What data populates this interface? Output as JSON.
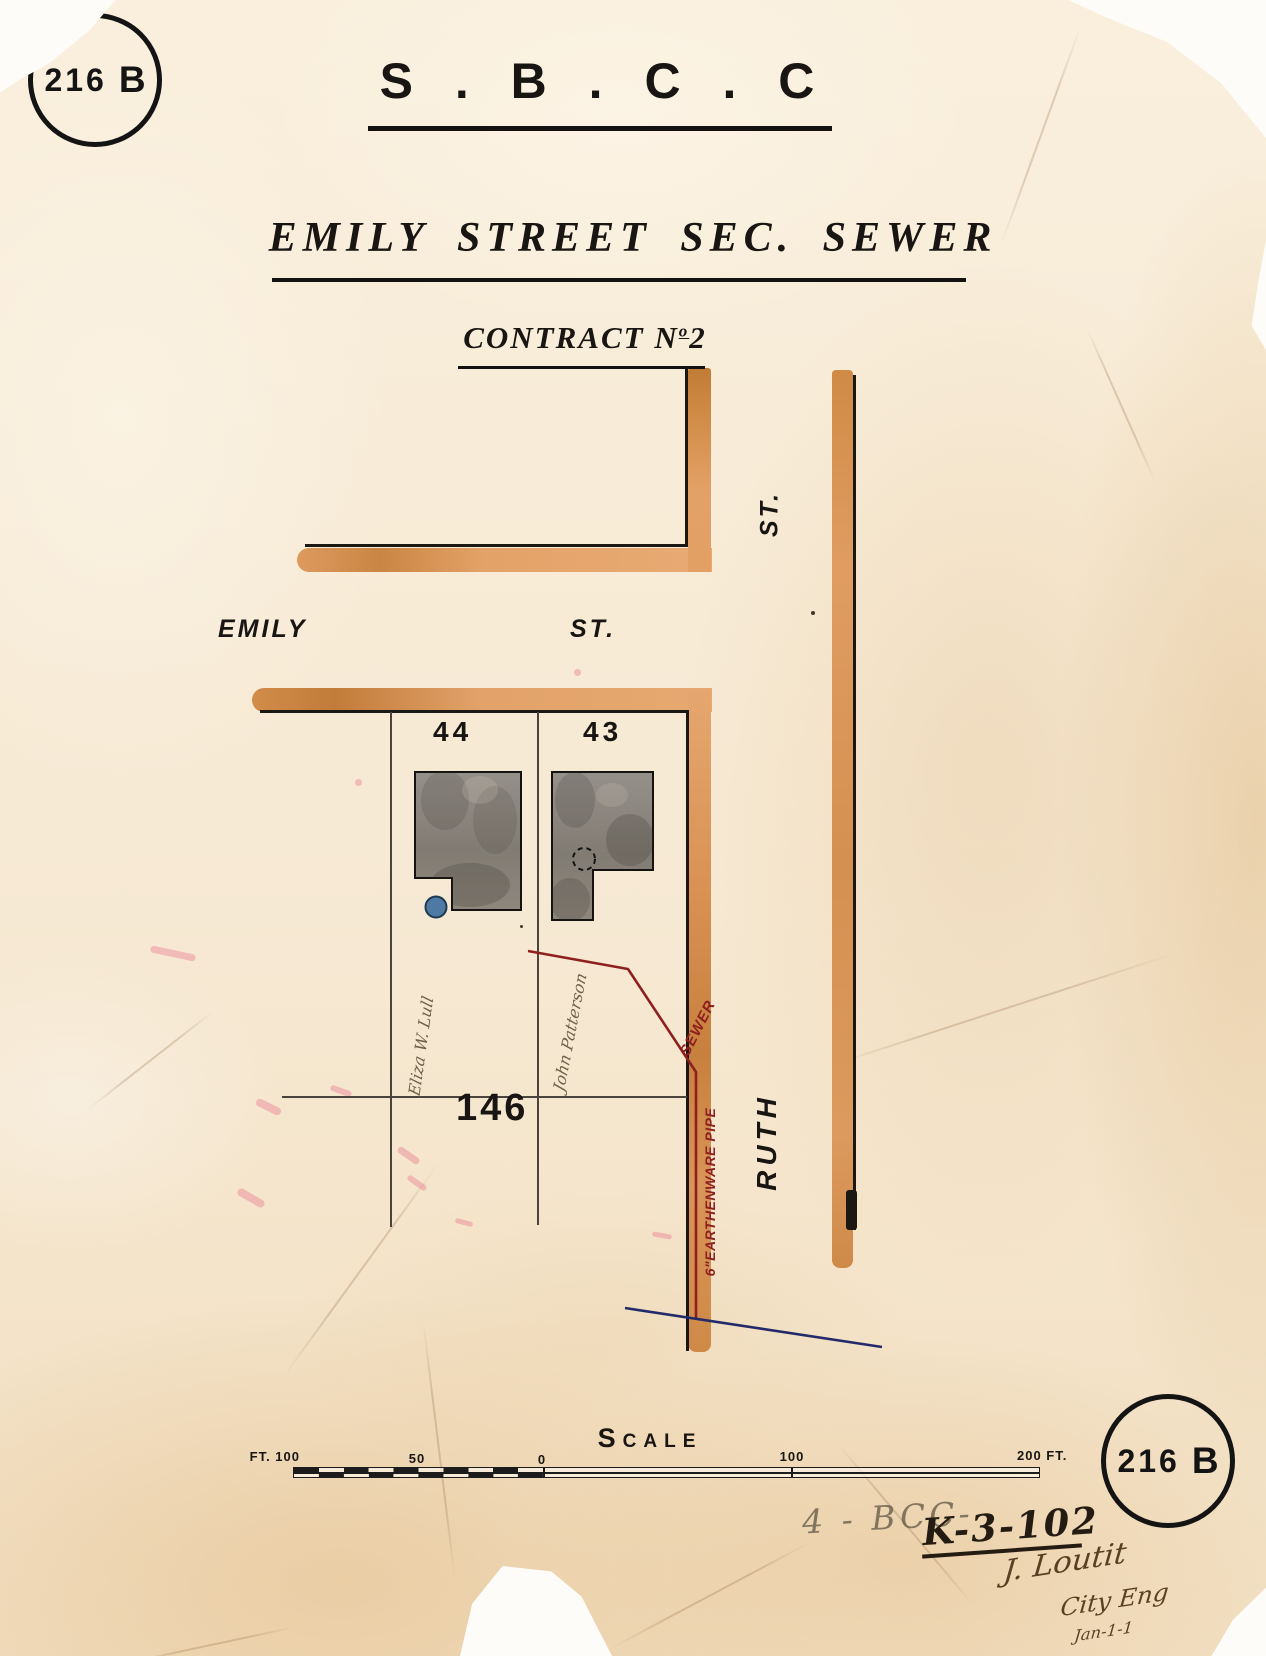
{
  "stamp": {
    "number": "216",
    "letter": "B"
  },
  "header": {
    "org": "S . B . C . C",
    "title": "EMILY STREET SEC. SEWER",
    "contract_prefix": "CONTRACT N",
    "contract_ordinal": "o",
    "contract_number": "2"
  },
  "map": {
    "street_emily": "EMILY",
    "street_emily_suffix": "ST.",
    "street_cross_suffix": "ST.",
    "street_ruth": "RUTH",
    "lot_44": "44",
    "lot_43": "43",
    "lot_146": "146",
    "owner_lot44": "Eliza W. Lull",
    "owner_lot43": "John Patterson",
    "sewer_label": "SEWER",
    "pipe_label": "6\"EARTHENWARE PIPE"
  },
  "scale_bar": {
    "heading_initial": "S",
    "heading_rest": "CALE",
    "tick_left": "FT. 100",
    "tick_50": "50",
    "tick_0": "0",
    "tick_100": "100",
    "tick_right": "200 FT."
  },
  "annotations": {
    "pencil_code": "4 - BCC-",
    "ink_code": "K-3-102",
    "signature": "J. Loutit",
    "signature_title": "City Eng",
    "signature_date": "Jan-1-1"
  },
  "colors": {
    "street_wash": "#e4a369",
    "sewer_red": "#8e1f1f",
    "survey_blue": "#232a6b",
    "building_gray": "#8a857b",
    "well_blue": "#4e79a3",
    "ink_black": "#1b1814"
  }
}
